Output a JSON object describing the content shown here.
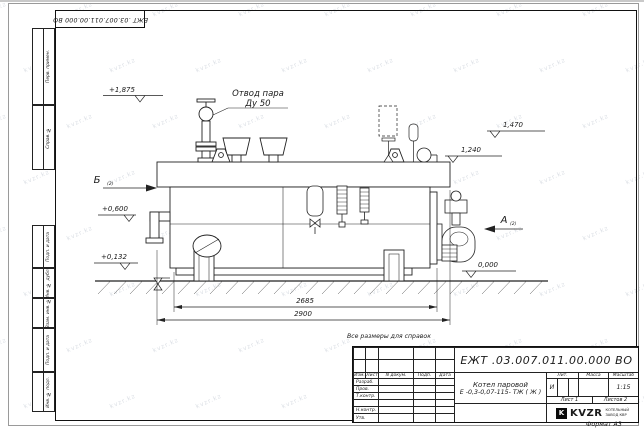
{
  "page": {
    "watermark": "kvzr.kz",
    "dims_note": "Все размеры для справок",
    "format_note": "Формат А3"
  },
  "corner_stamp": {
    "doc_number": "ЕЖТ .03.007.011.00.000  ВО"
  },
  "side_stamps": {
    "items": [
      "Перв. примен.",
      "Справ. №",
      "Подп. и дата",
      "Инв. № дубл.",
      "Взам. инв. №",
      "Подп. и дата",
      "Инв. № подл."
    ]
  },
  "drawing": {
    "steam_outlet": {
      "line1": "Отвод пара",
      "line2": "Ду 50"
    },
    "views": {
      "b": "Б",
      "b_ref": "(2)",
      "a": "А",
      "a_ref": "(2)"
    },
    "elevations": {
      "top": "+1,875",
      "mid": "+0,600",
      "low": "+0,132",
      "right_top": "1,470",
      "right_mid": "1,240",
      "ground": "0,000"
    },
    "dimensions": {
      "shell_length": "2685",
      "overall_length": "2900"
    }
  },
  "title_block": {
    "doc_number": "ЕЖТ .03.007.011.00.000  ВО",
    "product_name": "Котел паровой",
    "product_model": "Е -0,3-0,07-115- ТЖ ( Ж )",
    "columns": {
      "izm": "Изм.",
      "list": "Лист",
      "doc": "N докум.",
      "sign": "Подп.",
      "date": "Дата"
    },
    "rows": {
      "developed": "Разраб.",
      "checked": "Пров.",
      "tcontrol": "Т.контр.",
      "ncontrol": "Н.контр.",
      "approved": "Утв."
    },
    "props": {
      "litera_label": "Лит.",
      "mass_label": "Масса",
      "scale_label": "Масштаб",
      "litera": "И",
      "scale": "1:15",
      "sheet": "Лист 1",
      "sheets": "Листов 2"
    },
    "logo": {
      "mark": "K",
      "name": "KVZR",
      "sub1": "КОТЕЛЬНЫЙ",
      "sub2": "ЗАВОД КВР"
    }
  }
}
